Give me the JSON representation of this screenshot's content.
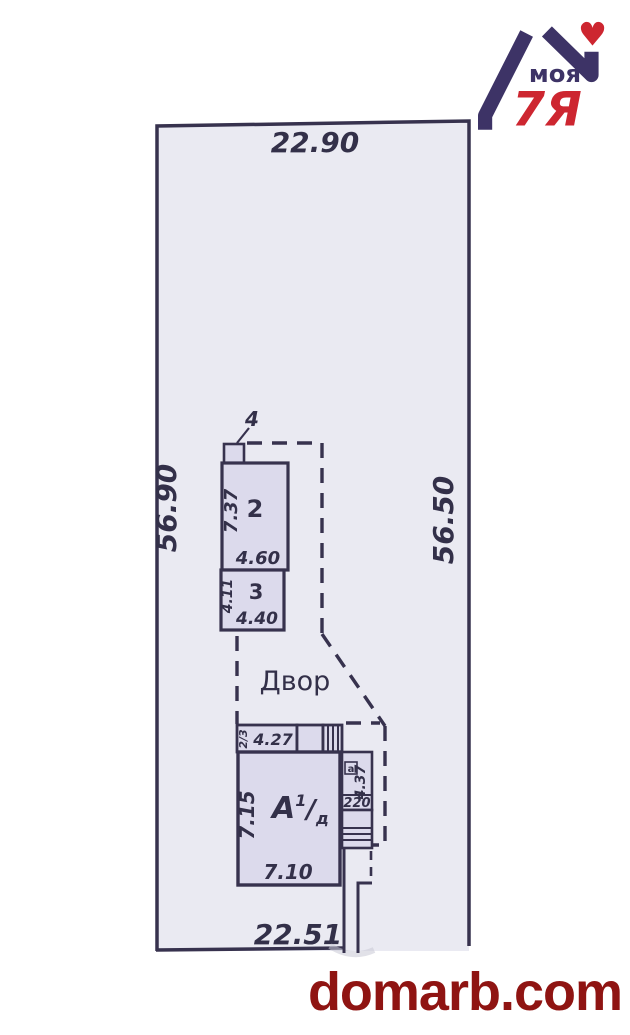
{
  "logo": {
    "brand_top": "моя",
    "brand_bottom": "7Я",
    "heart_icon": "♥",
    "navy": "#3d3366",
    "red": "#cd2630"
  },
  "watermark": {
    "text": "domarb.com",
    "color": "#8f1412"
  },
  "plan": {
    "colors": {
      "line": "#37324e",
      "plot_fill": "#eaeaf2",
      "building_fill": "#dcdaec",
      "text": "#333049"
    },
    "plot": {
      "width_top": "22.90",
      "height_left": "56.90",
      "height_right": "56.50",
      "width_bottom": "22.51"
    },
    "yard_label": "Двор",
    "sheds": {
      "porch_label": "4",
      "b2": {
        "label": "2",
        "height": "7.37",
        "width": "4.60"
      },
      "b3": {
        "label": "3",
        "height": "4.11",
        "width": "4.40"
      }
    },
    "main": {
      "strip": {
        "floor": "2/3",
        "width": "4.27"
      },
      "house": {
        "letter": "А",
        "sup": "1",
        "slash": "/",
        "sub": "д",
        "height": "7.15",
        "width": "7.10"
      },
      "annex": {
        "label": "а",
        "height": "4.37",
        "width": "220"
      }
    }
  }
}
